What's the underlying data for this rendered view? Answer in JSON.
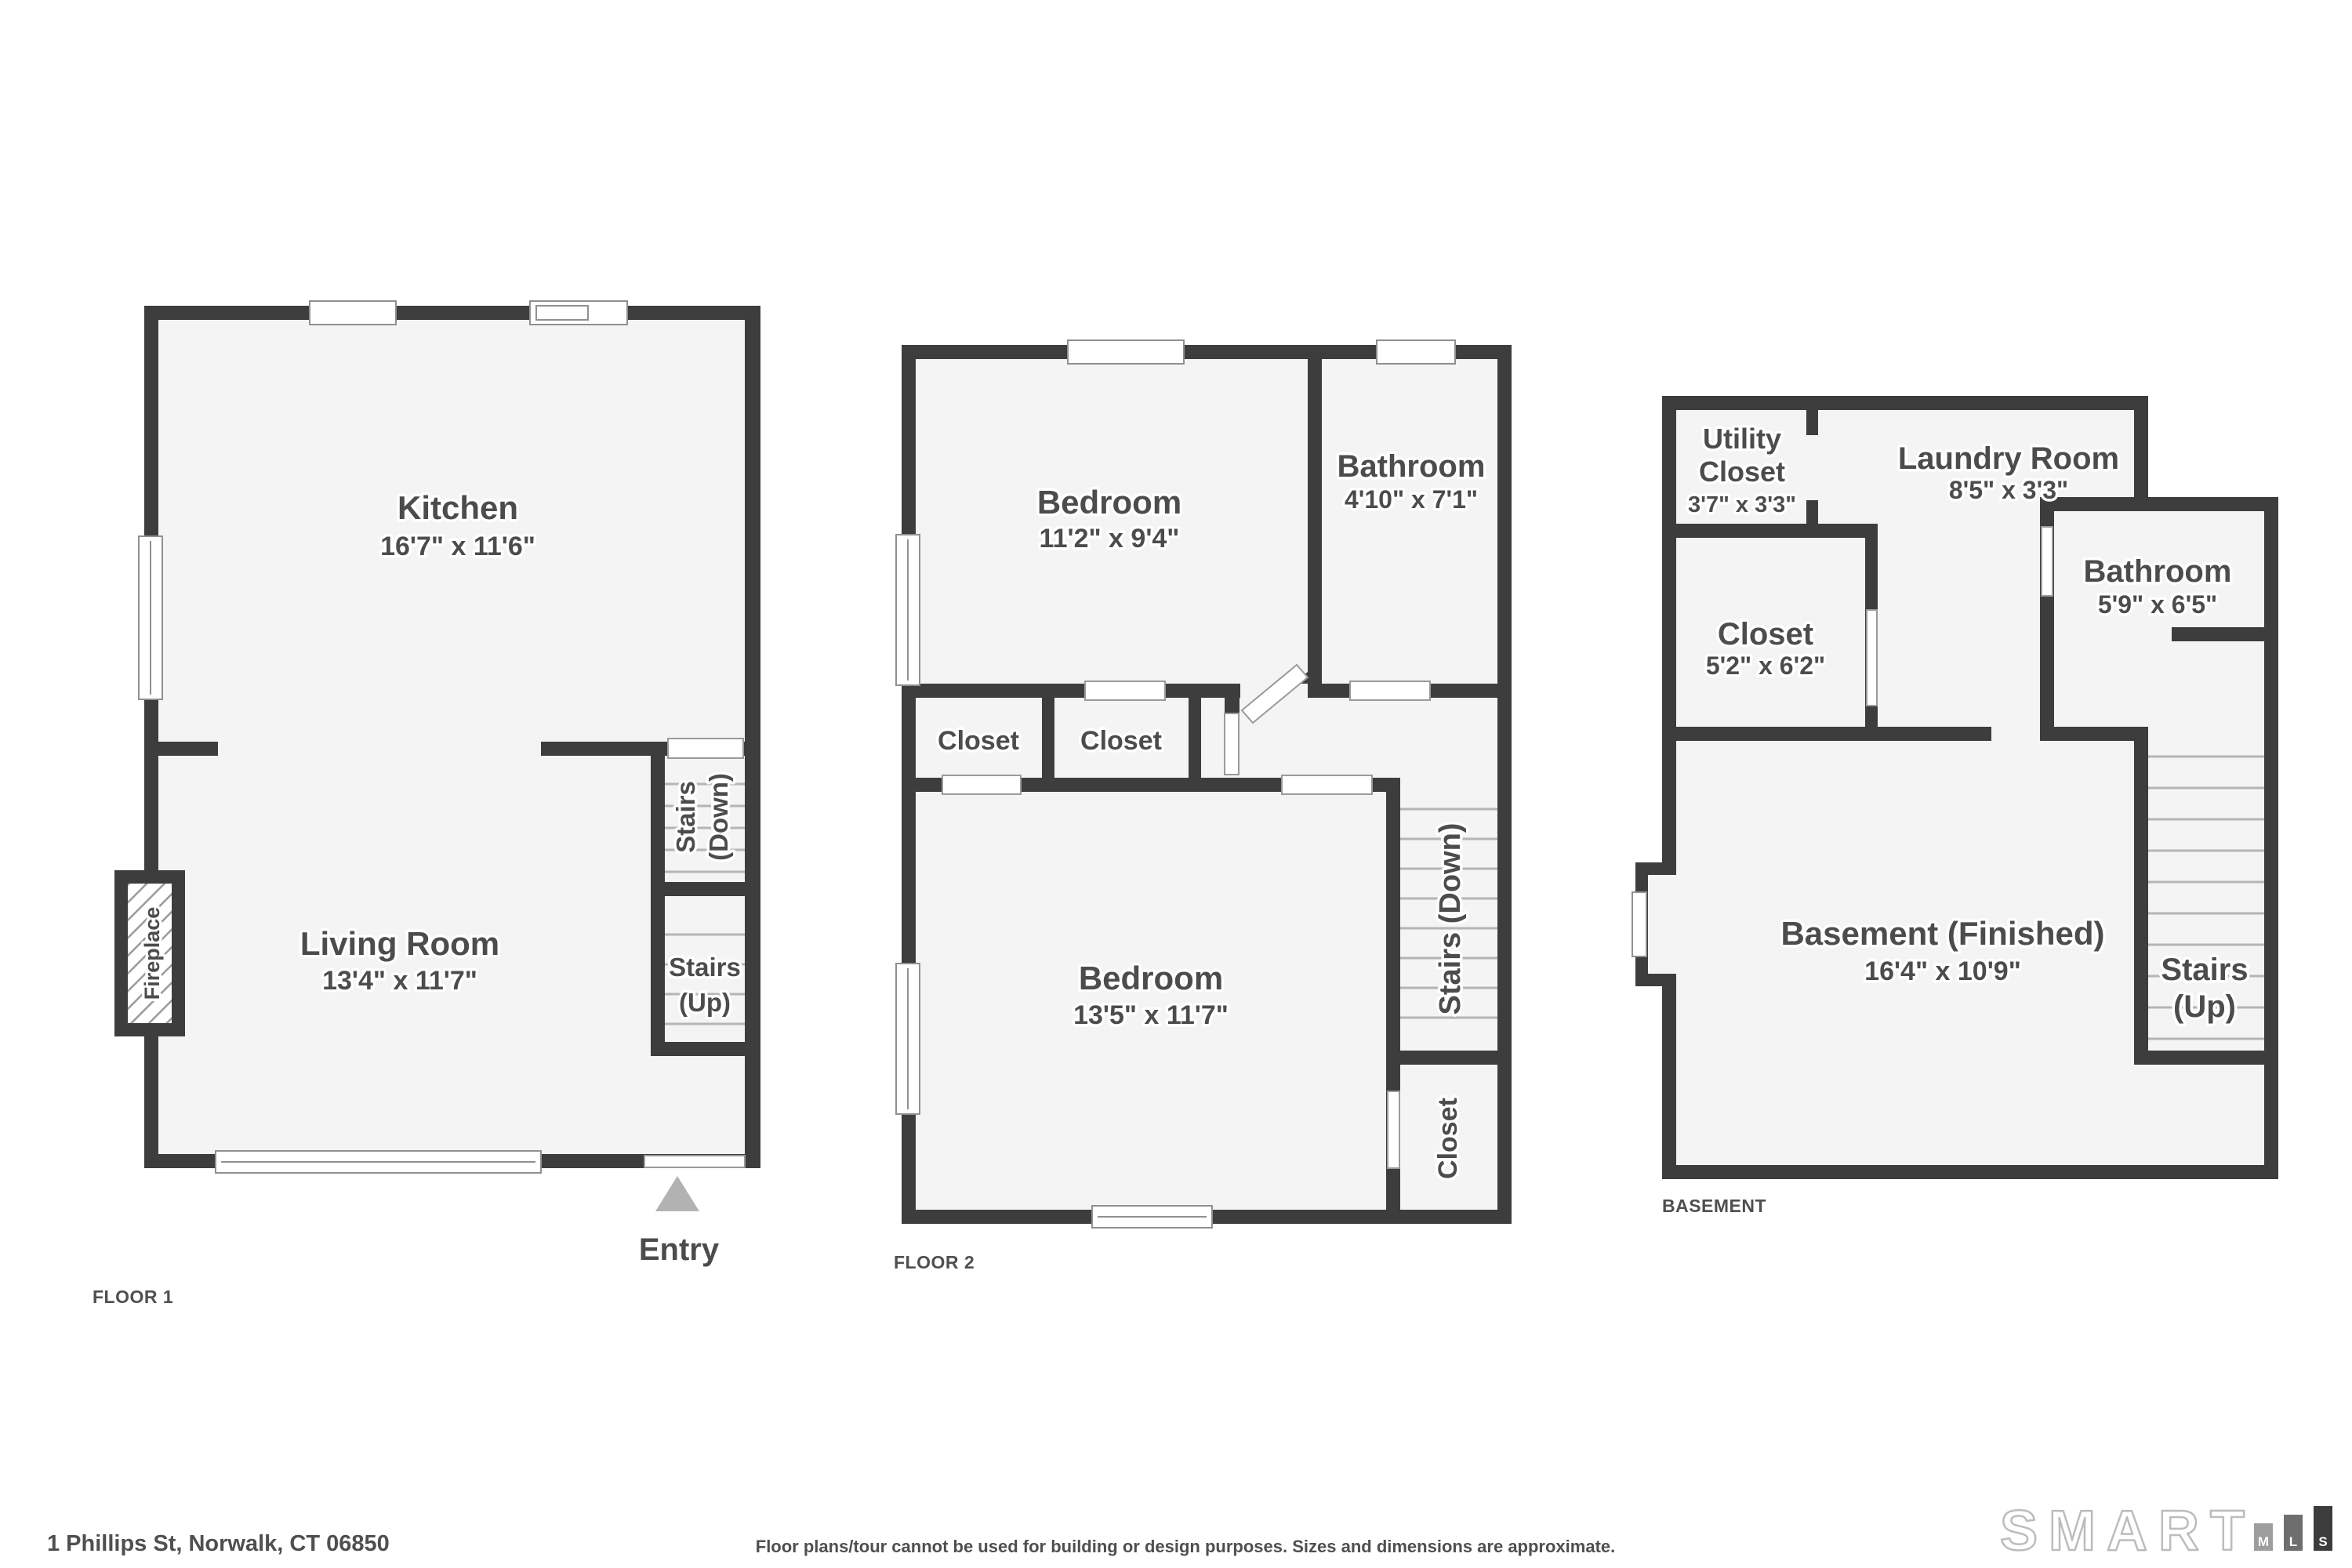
{
  "colors": {
    "wall": "#3d3d3d",
    "floor_fill": "#f4f4f4",
    "label_text": "#4c4c4c",
    "entry_arrow": "#b2b2b2",
    "logo_bar_m": "#9e9e9e",
    "logo_bar_l": "#6e6e6e",
    "logo_bar_s": "#3c3c3c"
  },
  "floor1": {
    "caption": "FLOOR 1",
    "kitchen_name": "Kitchen",
    "kitchen_dims": "16'7\" x 11'6\"",
    "living_name": "Living Room",
    "living_dims": "13'4\" x 11'7\"",
    "stairs_down_line1": "Stairs",
    "stairs_down_line2": "(Down)",
    "stairs_up_line1": "Stairs",
    "stairs_up_line2": "(Up)",
    "fireplace": "Fireplace",
    "entry": "Entry"
  },
  "floor2": {
    "caption": "FLOOR 2",
    "bedroom1_name": "Bedroom",
    "bedroom1_dims": "11'2\" x 9'4\"",
    "bathroom_name": "Bathroom",
    "bathroom_dims": "4'10\" x 7'1\"",
    "closet1": "Closet",
    "closet2": "Closet",
    "bedroom2_name": "Bedroom",
    "bedroom2_dims": "13'5\" x 11'7\"",
    "stairs_down": "Stairs (Down)",
    "closet3": "Closet"
  },
  "basement": {
    "caption": "BASEMENT",
    "utility_line1": "Utility",
    "utility_line2": "Closet",
    "utility_dims": "3'7\" x 3'3\"",
    "laundry_name": "Laundry Room",
    "laundry_dims": "8'5\" x 3'3\"",
    "closet_name": "Closet",
    "closet_dims": "5'2\" x 6'2\"",
    "bathroom_name": "Bathroom",
    "bathroom_dims": "5'9\" x 6'5\"",
    "main_name": "Basement (Finished)",
    "main_dims": "16'4\" x 10'9\"",
    "stairs_up_line1": "Stairs",
    "stairs_up_line2": "(Up)"
  },
  "footer": {
    "address": "1 Phillips St, Norwalk, CT 06850",
    "disclaimer": "Floor plans/tour cannot be used for building or design purposes. Sizes and dimensions are approximate.",
    "logo_word": "SMART",
    "logo_m": "M",
    "logo_l": "L",
    "logo_s": "S"
  }
}
